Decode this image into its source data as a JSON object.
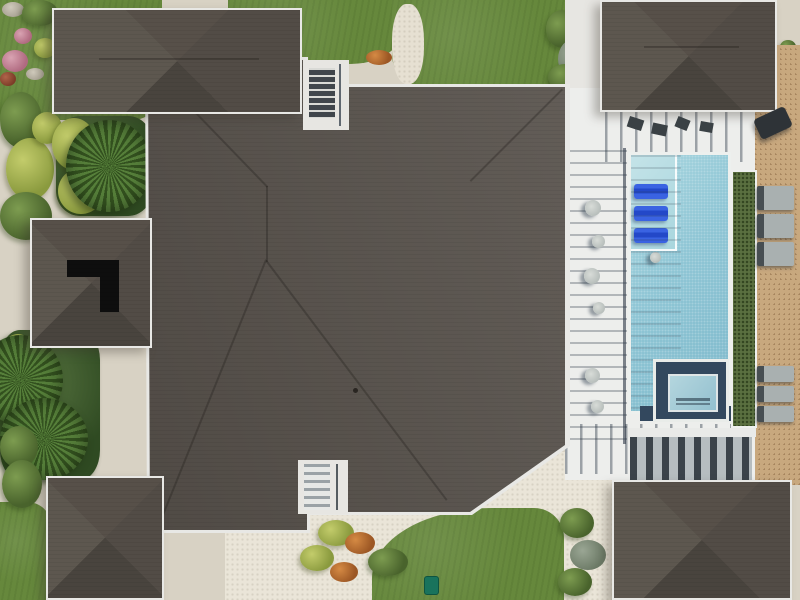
{
  "scene": {
    "title": "Aerial drone view of a tropical villa with dark hip roofs, pool terrace and wooden sun deck",
    "type": "top-down photograph",
    "contains_text": false
  },
  "colors": {
    "driveway": "#d8d2c4",
    "sand_light": "#eae5d8",
    "white_structure": "#e7e6e2",
    "pool_deck": "#edeeec",
    "lawn": "#66883c",
    "roof_shingle": "#59534d",
    "roof_trim": "#e8e8e5",
    "roof_vent_black": "#0e0e0e",
    "pool_water": "#8ac3d3",
    "pool_ledge": "#b9dde4",
    "spa_coping": "#33485e",
    "lounger_blue": "#2d55d6",
    "lounger_gray": "#a9b0b0",
    "deck_wood": "#c8a87e",
    "planter_green": "#5a7040",
    "pergola_slat": "#3b434a",
    "trash_can_green": "#19735c"
  },
  "objects": {
    "main_roof": {
      "label": "Main hip roof of villa"
    },
    "roof_wings": {
      "label": "Hip-roof wings around courtyards",
      "count": 5
    },
    "roof_vent": {
      "label": "Black L-shaped opening in left wing roof"
    },
    "skylight_court": {
      "label": "Stair courtyard cut into roof, top centre"
    },
    "entry_porch": {
      "label": "White entry porch with steps, bottom centre"
    },
    "pool": {
      "label": "Rectangular pool with tanning ledge"
    },
    "pool_loungers": {
      "label": "Submerged blue ledge loungers",
      "count": 3
    },
    "spa": {
      "label": "Square spa with dark coping below pool"
    },
    "pool_fence": {
      "label": "Pool fence casting long horizontal shadows"
    },
    "planter": {
      "label": "Hedge planter between pool and deck"
    },
    "wood_deck": {
      "label": "Diagonal-plank wooden sun deck, right edge"
    },
    "deck_loungers": {
      "label": "Grey cushioned deck loungers",
      "count": 6
    },
    "grill": {
      "label": "Dark barbecue grill on deck"
    },
    "pergola": {
      "label": "Slatted pergola shade, bottom right"
    },
    "palms": {
      "label": "Palm trees in side courtyards",
      "count": 3
    },
    "lawns": {
      "label": "Green turf lawns top and bottom",
      "count": 5
    },
    "sand_paths": {
      "label": "White sand garden paths and pale driveway"
    },
    "flower_bed": {
      "label": "Rock and flower bed, top-left corner"
    },
    "trash_can": {
      "label": "Green bin on bottom lawn"
    }
  }
}
